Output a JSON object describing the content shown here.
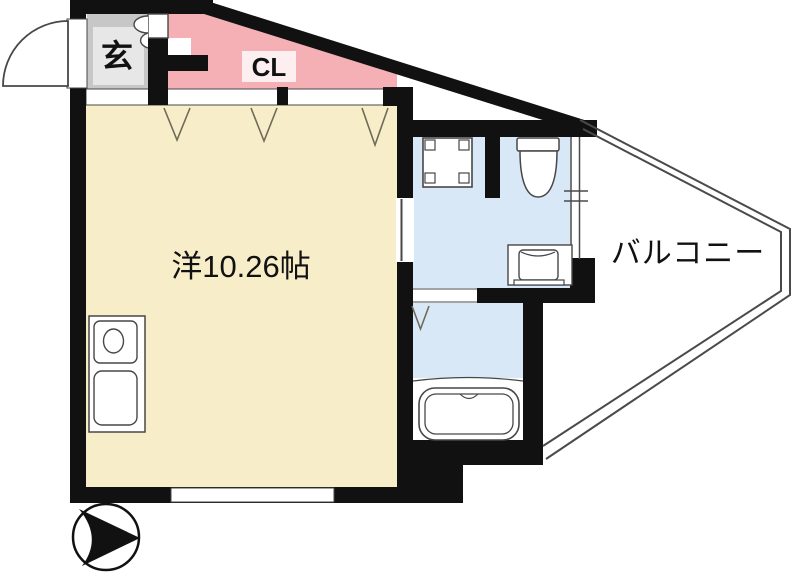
{
  "plan": {
    "entrance_label": "玄",
    "closet_label": "CL",
    "room_label": "洋10.26帖",
    "balcony_label": "バルコニー"
  },
  "colors": {
    "wall": "#111111",
    "outline": "#474747",
    "closet": "#f5b0b6",
    "closet_label_box": "#fdeff0",
    "room": "#f8edc9",
    "wet": "#d9e8f7",
    "entrance_outer": "#c7c7c7",
    "entrance_inner": "#e7e7e7",
    "door_mark": "#6e6c58",
    "balcony_line": "#4a4a4a",
    "text": "#111111",
    "background": "#ffffff"
  }
}
